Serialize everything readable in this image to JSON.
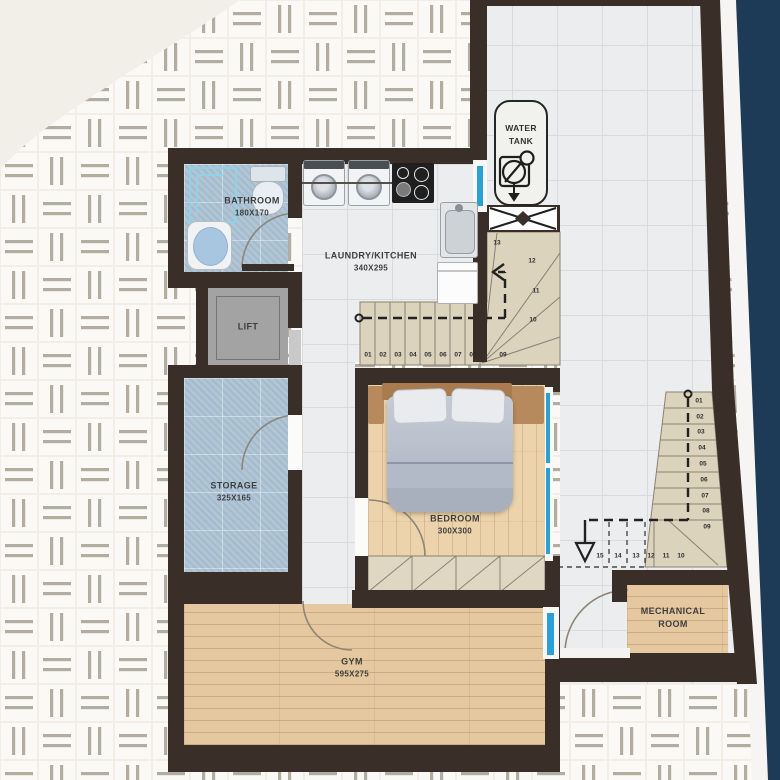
{
  "rooms": {
    "bathroom": {
      "name": "BATHROOM",
      "dims": "180X170"
    },
    "kitchen": {
      "name": "LAUNDRY/KITCHEN",
      "dims": "340X295"
    },
    "lift": {
      "name": "LIFT"
    },
    "storage": {
      "name": "STORAGE",
      "dims": "325X165"
    },
    "bedroom": {
      "name": "BEDROOM",
      "dims": "300X300"
    },
    "gym": {
      "name": "GYM",
      "dims": "595X275"
    },
    "mechanical": {
      "name": "MECHANICAL ROOM"
    },
    "water_tank": {
      "name": "WATER TANK"
    }
  },
  "stairs": {
    "main_flight": [
      "01",
      "02",
      "03",
      "04",
      "05",
      "06",
      "07",
      "08",
      "09"
    ],
    "winders": [
      "10",
      "11",
      "12",
      "13"
    ],
    "right_flight": [
      "01",
      "02",
      "03",
      "04",
      "05",
      "06",
      "07",
      "08",
      "09"
    ],
    "lower_flight": [
      "15",
      "14",
      "13",
      "12",
      "11",
      "10"
    ]
  },
  "colors": {
    "wall": "#3a2e28",
    "sky_band": "#1d3a57",
    "glass_accent": "#2aa0d4",
    "stair_tread": "#dcd3bd",
    "wood_floor": "#e5c89f",
    "bedroom_floor": "#ecd3ab",
    "blue_tile": "#b0c6d6",
    "marble_tile": "#ecedee",
    "paper_background": "#f2eee7"
  }
}
